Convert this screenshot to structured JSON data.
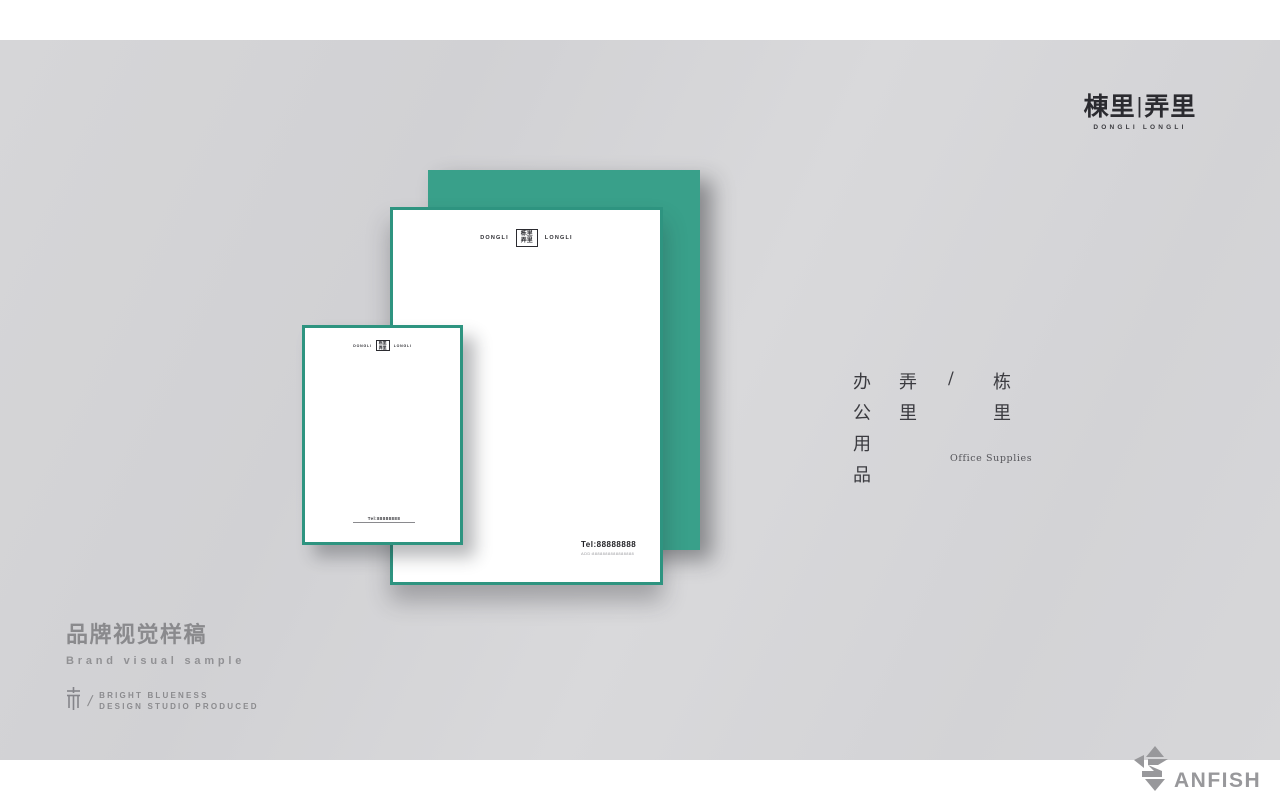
{
  "brand": {
    "logo_zh_left": "棟里",
    "logo_divider": "|",
    "logo_zh_right": "弄里",
    "logo_sub": "DONGLI LONGLI"
  },
  "mockup": {
    "letterhead": {
      "header_left": "DONGLI",
      "header_right": "LONGLI",
      "seal_row1": "栋里",
      "seal_row2": "弄里",
      "tel": "Tel:88888888",
      "address_line": "ADD:8888888888888888"
    }
  },
  "side_text": {
    "col_product": [
      "办",
      "公",
      "用",
      "品"
    ],
    "col_longli": [
      "弄",
      "里"
    ],
    "slash": "/",
    "col_dongli": [
      "栋",
      "里"
    ],
    "caption_en": "Office Supplies"
  },
  "footer": {
    "title_zh": "品牌视觉样稿",
    "title_en": "Brand visual sample",
    "slash": "/",
    "studio_line1": "BRIGHT BLUENESS",
    "studio_line2": "DESIGN STUDIO PRODUCED"
  },
  "watermark": {
    "text_after_glyph": "ANFISH",
    "full_name": "SANFISH"
  },
  "colors": {
    "teal": "#39a08a",
    "teal_border": "#2e9480",
    "ink": "#2b2b30",
    "title_gray": "#8a8a8d",
    "watermark_gray": "#98989b",
    "stage_gray": "#d4d4d7"
  }
}
